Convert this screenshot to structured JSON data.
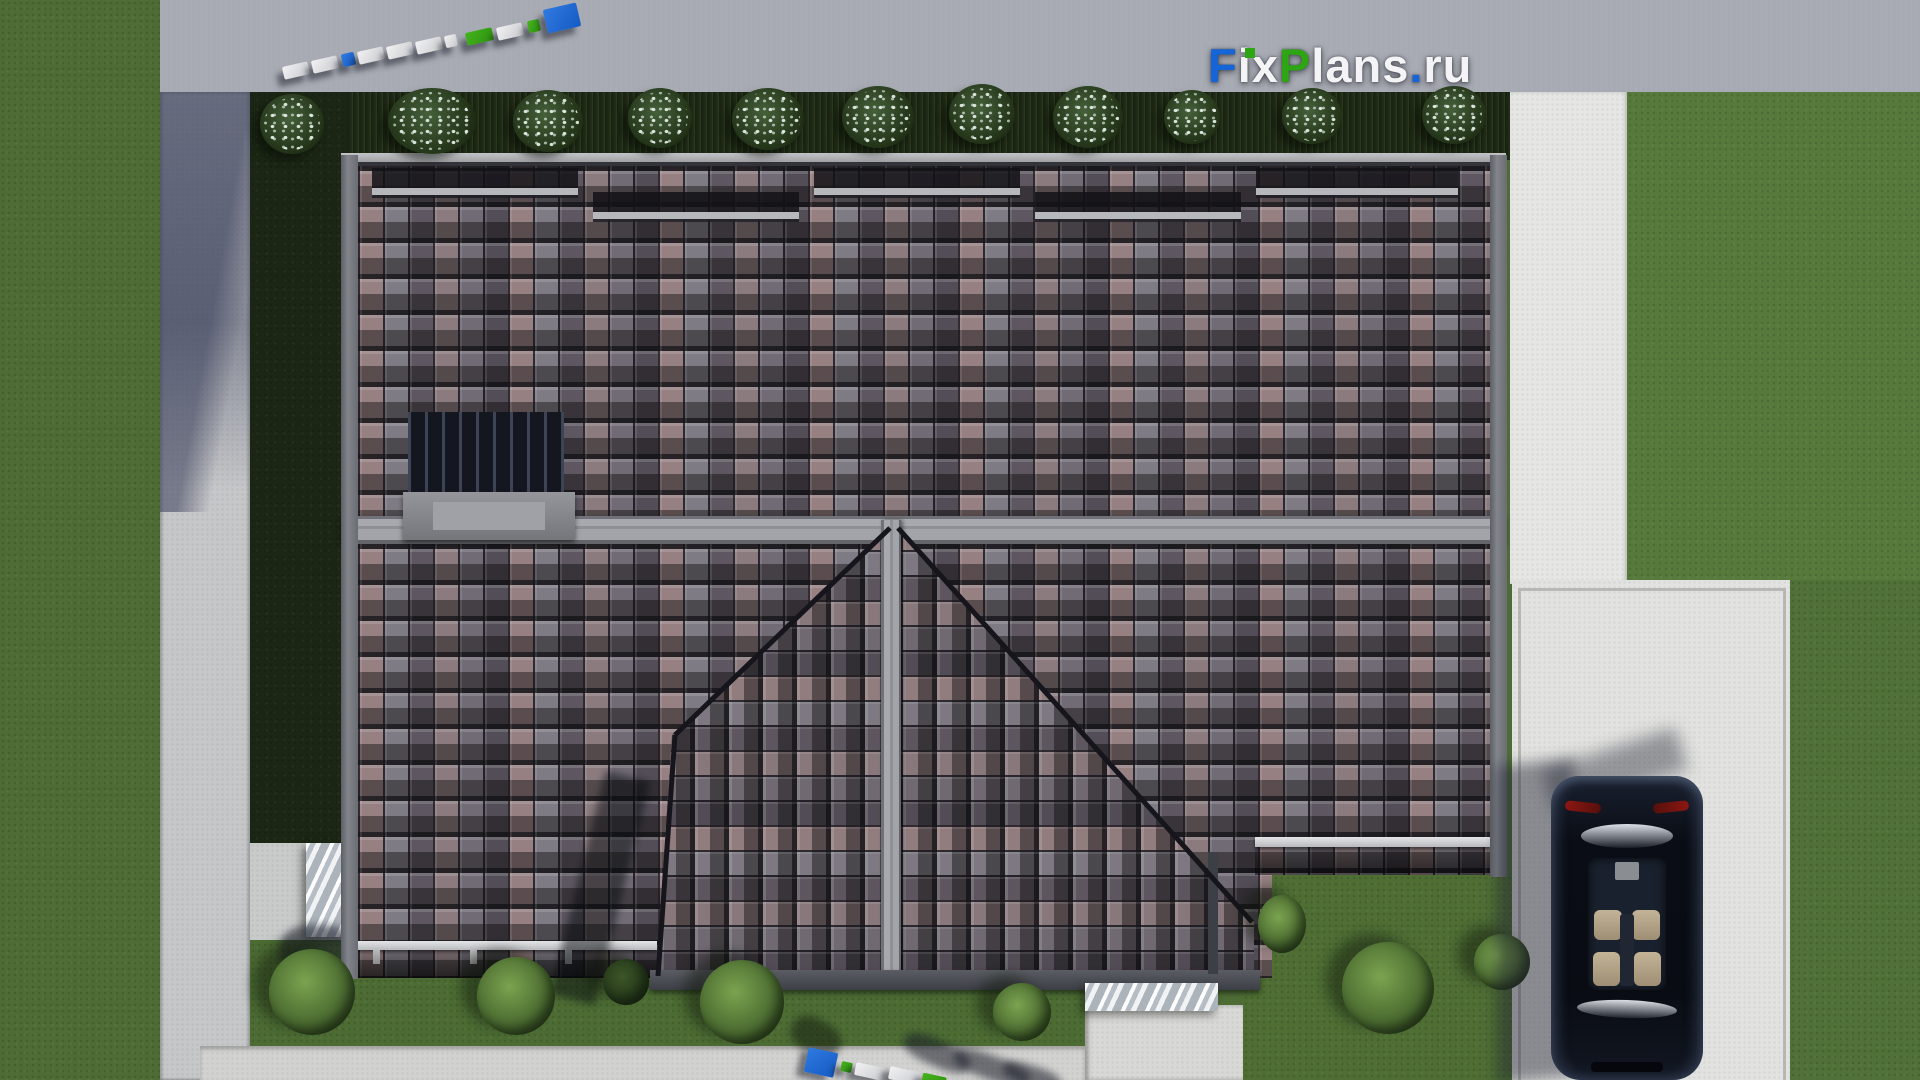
{
  "watermark": {
    "text": "FixPlans.ru",
    "segments": [
      {
        "t": "F",
        "c": "#1565d8"
      },
      {
        "t": "ix",
        "c": "#f4f4f6"
      },
      {
        "t": "P",
        "c": "#2ea513"
      },
      {
        "t": "lans",
        "c": "#f4f4f6"
      },
      {
        "t": ".",
        "c": "#1565d8"
      },
      {
        "t": "ru",
        "c": "#f4f4f6"
      }
    ],
    "brand_colors": {
      "blue": "#1565d8",
      "green": "#2ea513",
      "white": "#f4f4f6"
    }
  },
  "scene": {
    "view": "top-down aerial render of a house",
    "roof_tile_colors": [
      "#8f7d7e",
      "#8a8890",
      "#3f3e45"
    ],
    "lawn_color": "#4e6c36",
    "concrete_color": "#e2e2e0",
    "car_color": "#0a0d15"
  }
}
